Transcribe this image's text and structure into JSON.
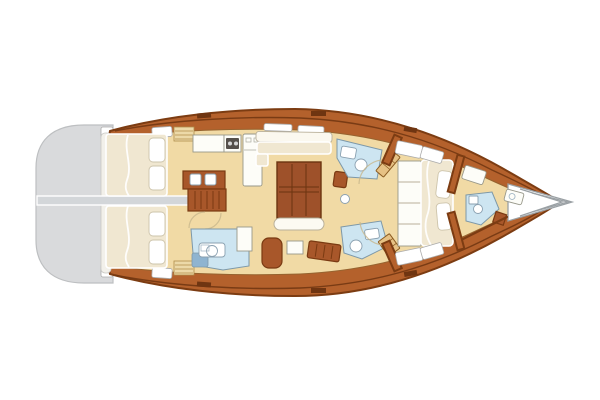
{
  "palette": {
    "background": "#ffffff",
    "hull_wood": "#b4612c",
    "hull_outline": "#7c3c12",
    "deck_line": "#6f3511",
    "floor_tan": "#f1daa5",
    "floor_outline": "#96632f",
    "platform_gray": "#d9dadc",
    "platform_outline": "#bdbfc1",
    "transom_white": "#f2f0ea",
    "divider_gray": "#d3d6d9",
    "berth_cream": "#f0e7d1",
    "berth_edge": "#ffffff",
    "pillow_white": "#ffffff",
    "pillow_edge": "#cdc4ab",
    "bath_blue": "#cde5f1",
    "bath_edge": "#7d98a8",
    "shower_blue": "#8fb4d0",
    "fixture_white": "#ffffff",
    "fixture_edge": "#8aa0b0",
    "counter_white": "#fdfdf8",
    "counter_edge": "#98988a",
    "stove_dark": "#55504b",
    "furniture_wood": "#a8572a",
    "furniture_wood_dark": "#7a3a12",
    "table_wood": "#9e512a",
    "table_dark": "#6b3410",
    "door_tan": "#e6c184",
    "door_edge": "#8a5a20",
    "ghost_line": "#c8b68c",
    "hatch_white": "#ffffff",
    "hatch_edge": "#ababab",
    "bow_gray": "#9aa0a4"
  }
}
